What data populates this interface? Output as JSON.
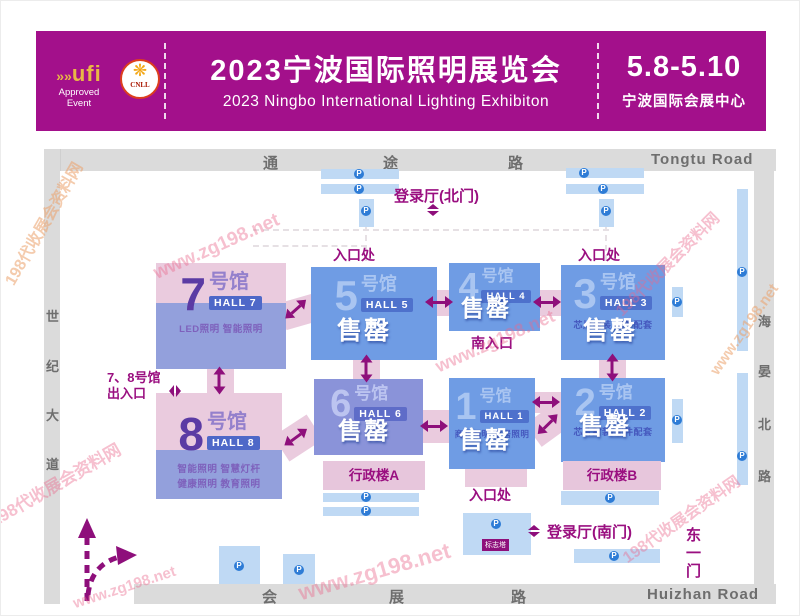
{
  "banner": {
    "ufi_label": "ufi",
    "ufi_sub1": "Approved",
    "ufi_sub2": "Event",
    "cnll_label": "CNLL",
    "title_cn": "2023宁波国际照明展览会",
    "title_en": "2023 Ningbo International Lighting Exhibiton",
    "dates": "5.8-5.10",
    "venue": "宁波国际会展中心"
  },
  "roads": {
    "top": [
      "通",
      "途",
      "路"
    ],
    "top_en": "Tongtu Road",
    "bottom": [
      "会",
      "展",
      "路"
    ],
    "bottom_en": "Huizhan Road",
    "left": [
      "世",
      "纪",
      "大",
      "道"
    ],
    "right": [
      "海",
      "晏",
      "北",
      "路"
    ]
  },
  "labels": {
    "sold_out": "售罄",
    "entrance": "入口处",
    "south_entrance": "南入口",
    "north_lobby": "登录厅(北门)",
    "south_lobby": "登录厅(南门)",
    "hall78_gate_line1": "7、8号馆",
    "hall78_gate_line2": "出入口",
    "east_gate": "东一门",
    "admin_a": "行政楼A",
    "admin_b": "行政楼B",
    "sign_tower": "标志塔"
  },
  "halls": {
    "h1": {
      "num": "1",
      "unit": "号馆",
      "badge": "HALL 1",
      "tags": "商业照明 家居照明"
    },
    "h2": {
      "num": "2",
      "unit": "号馆",
      "badge": "HALL 2",
      "tags": "芯片封装/配件配套"
    },
    "h3": {
      "num": "3",
      "unit": "号馆",
      "badge": "HALL 3",
      "tags": "芯片封装/配件配套"
    },
    "h4": {
      "num": "4",
      "unit": "号馆",
      "badge": "HALL 4"
    },
    "h5": {
      "num": "5",
      "unit": "号馆",
      "badge": "HALL 5"
    },
    "h6": {
      "num": "6",
      "unit": "号馆",
      "badge": "HALL 6"
    },
    "h7": {
      "num": "7",
      "unit": "号馆",
      "badge": "HALL 7",
      "tags": "LED照明  智能照明"
    },
    "h8": {
      "num": "8",
      "unit": "号馆",
      "badge": "HALL 8",
      "tags": "智能照明  智慧灯杆",
      "tags2": "健康照明  教育照明"
    }
  },
  "icons": {
    "ufi_arrows": "»»",
    "cnll_flower": "❋",
    "parking": "P"
  },
  "watermark": {
    "site": "198代收展会资料网",
    "url": "www.zg198.net"
  },
  "colors": {
    "banner_magenta": "#A3108B",
    "hall_blue": "#6F9CE4",
    "hall_lavender": "#8A93D9",
    "corridor_pink": "#EACBDE",
    "label_magenta": "#9A0F80",
    "road_gray": "#DBDBDB",
    "parking_blue": "#BFD9F4"
  }
}
